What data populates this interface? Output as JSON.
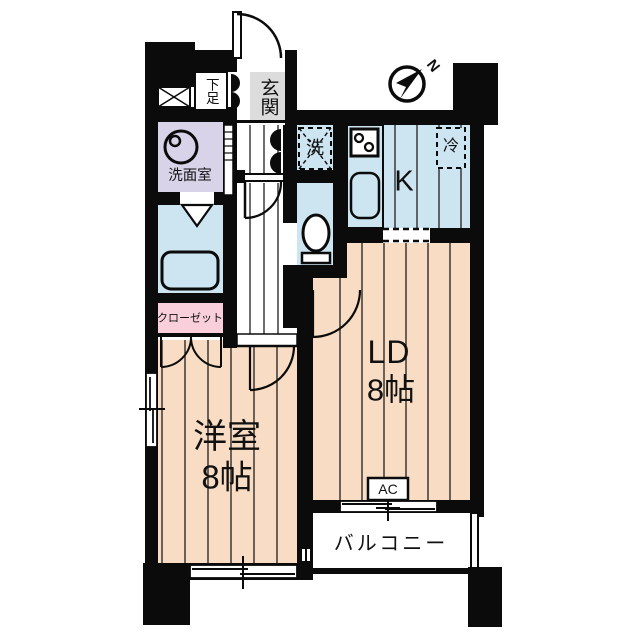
{
  "floorplan": {
    "compass": {
      "label": "N"
    },
    "entrance": {
      "label": "玄関"
    },
    "shoe_storage": {
      "label": "下足"
    },
    "washroom": {
      "label": "洗面室"
    },
    "washer_space": {
      "label": "洗"
    },
    "kitchen": {
      "label": "K"
    },
    "refrigerator_space": {
      "label": "冷"
    },
    "closet": {
      "label": "クローゼット"
    },
    "living_dining": {
      "label": "LD",
      "size": "8帖"
    },
    "western_room": {
      "label": "洋室",
      "size": "8帖"
    },
    "balcony": {
      "label": "バルコニー"
    },
    "air_conditioner": {
      "label": "AC"
    },
    "colors": {
      "wall": "#0b0b0b",
      "flooring": "#f8dcc3",
      "wet_area_blue": "#cde4f1",
      "washroom_lavender": "#d8d3e8",
      "closet_pink": "#f8cfdb",
      "entrance_gray": "#dcdcdc"
    }
  }
}
